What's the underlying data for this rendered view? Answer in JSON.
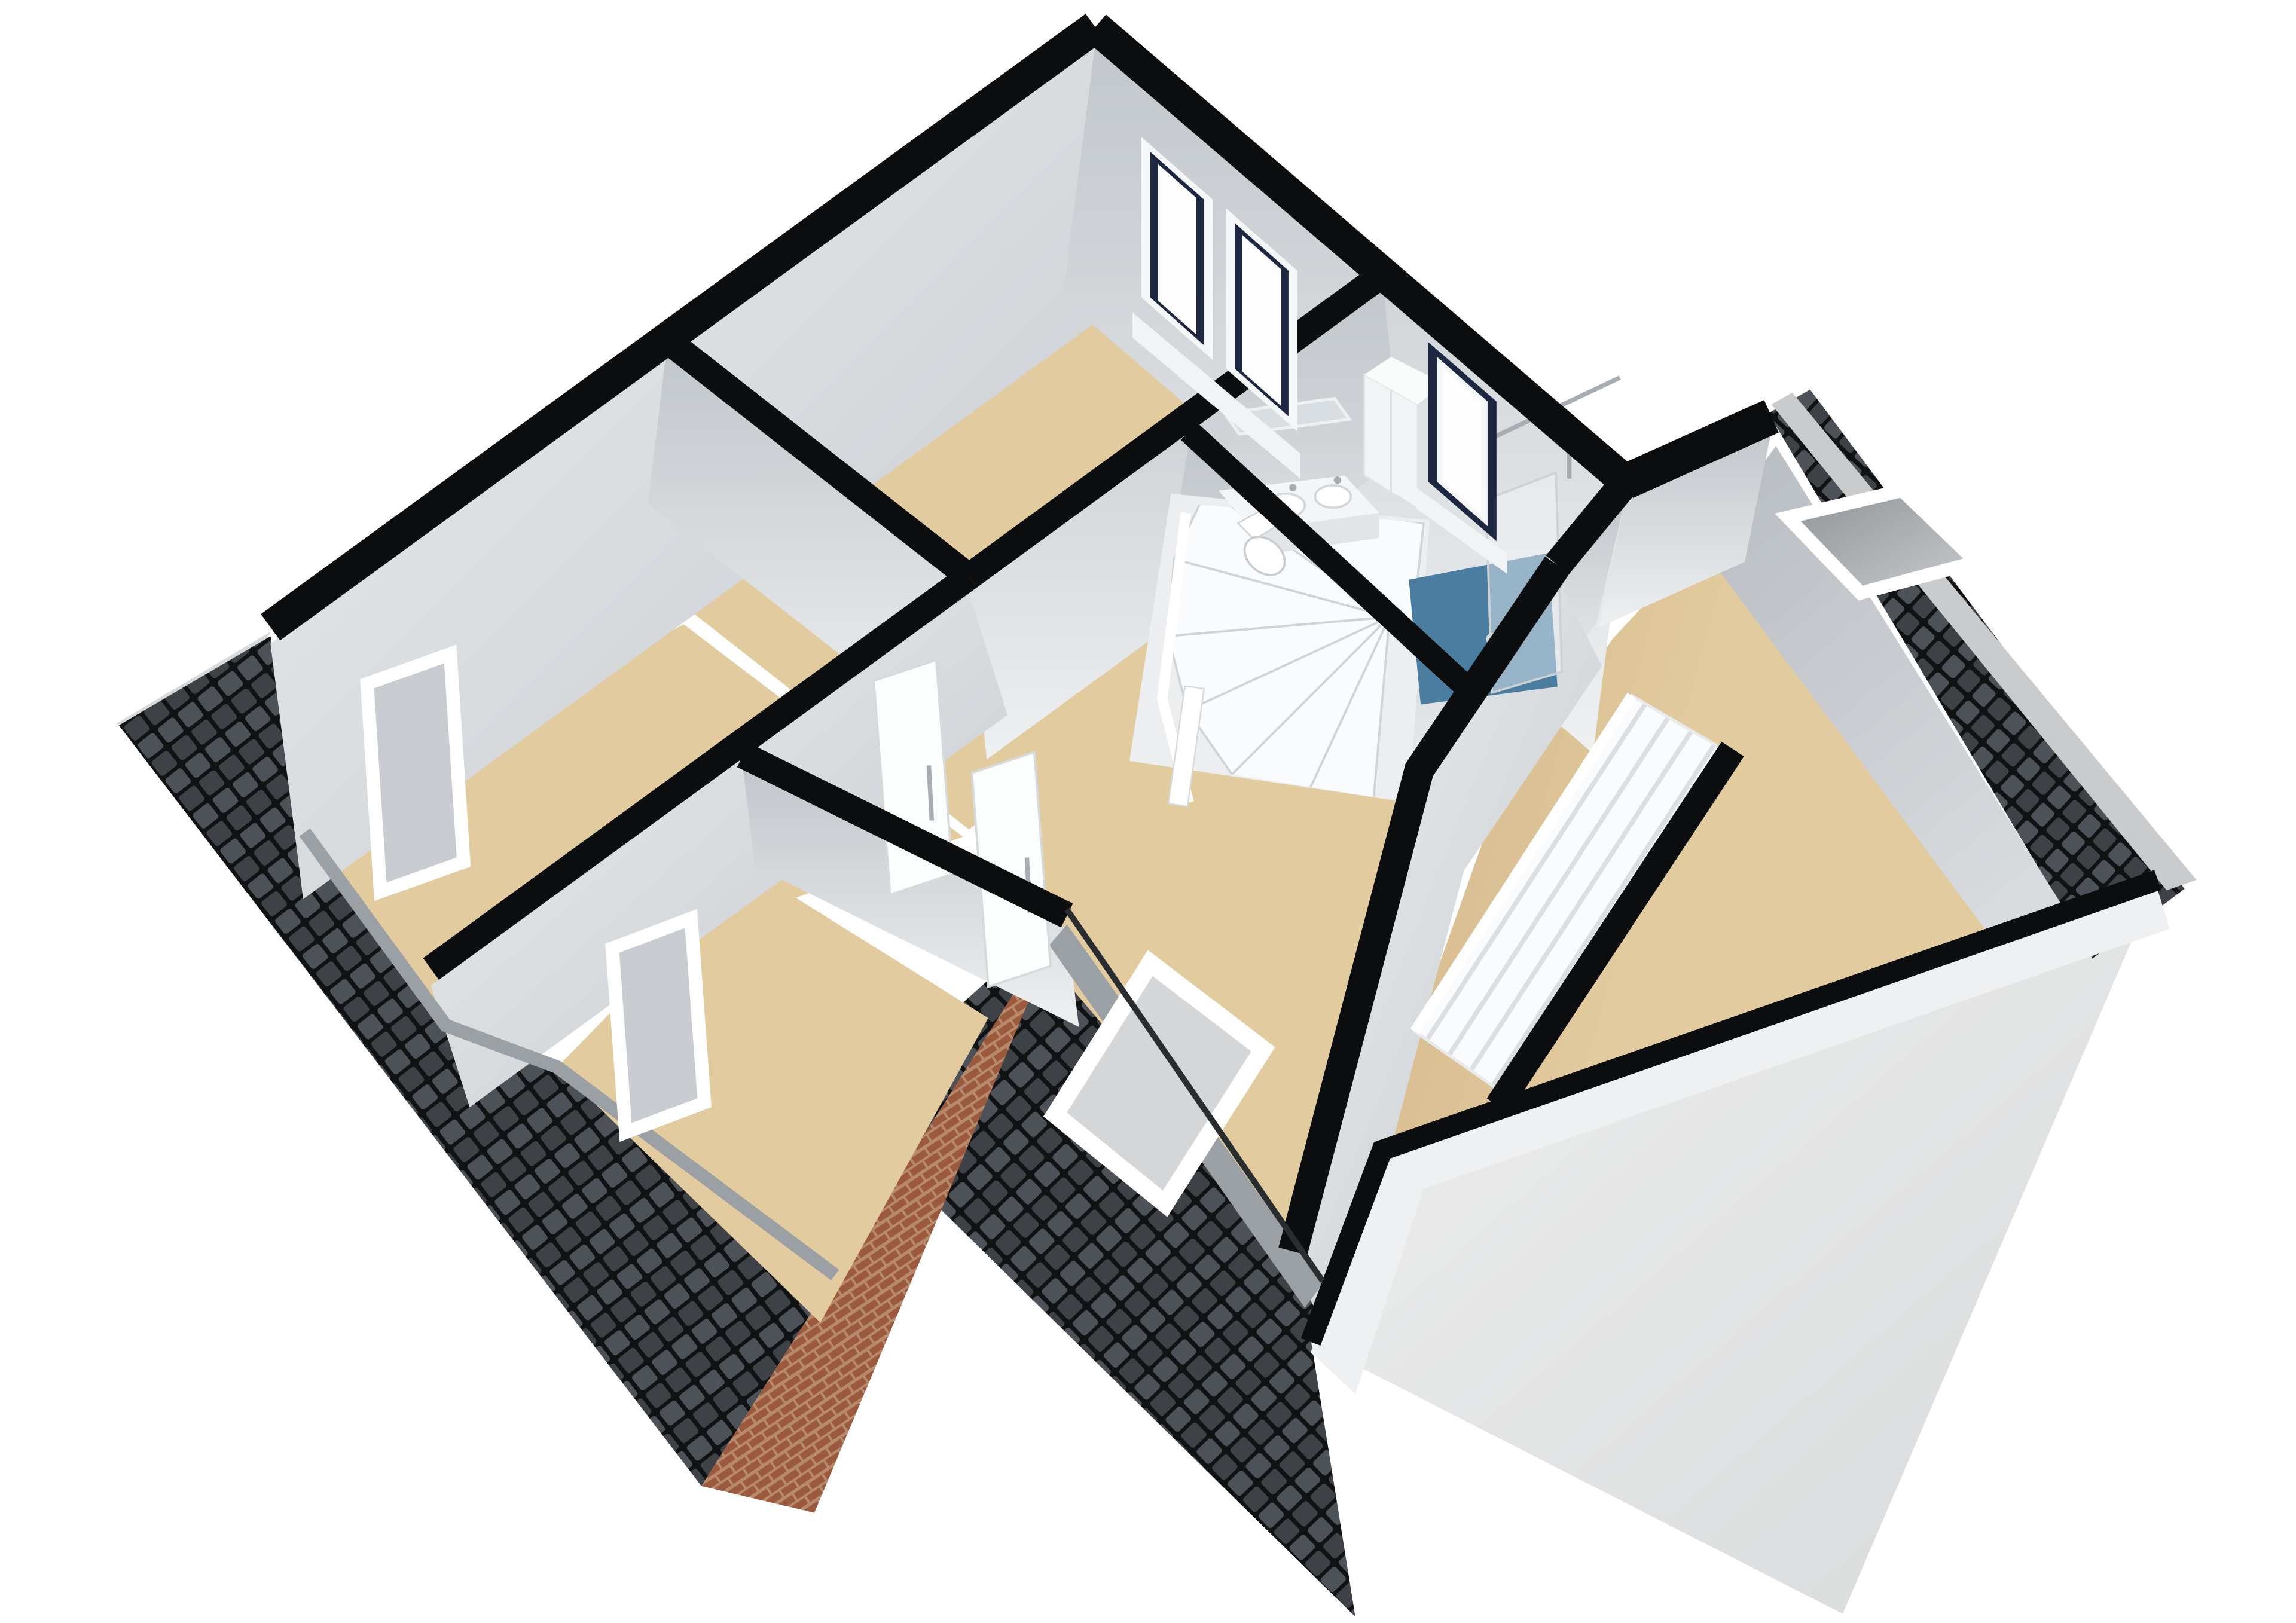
{
  "scene": {
    "label": "3D attic floor plan rendering",
    "view": "isometric-cutaway-top",
    "background": "white",
    "rooms": [
      {
        "name": "bedroom-top",
        "floor": "beige",
        "features": [
          "double-window-navy-frames"
        ]
      },
      {
        "name": "bathroom",
        "floor": "grey-with-blue-shower",
        "features": [
          "vanity-two-basins",
          "mirror",
          "tall-cabinet",
          "toilet",
          "walk-in-shower-blue-floor",
          "glass-panel",
          "shower-rod",
          "navy-framed-window"
        ]
      },
      {
        "name": "bedroom-left",
        "floor": "beige",
        "features": [
          "open-door-frame"
        ]
      },
      {
        "name": "room-small-middle",
        "floor": "beige",
        "features": [
          "open-door-frame"
        ]
      },
      {
        "name": "hallway-landing",
        "floor": "beige",
        "features": [
          "spiral-winder-staircase",
          "two-white-doors-with-handles",
          "handrail"
        ]
      },
      {
        "name": "big-room-right-wing",
        "floor": "beige",
        "features": [
          "straight-staircase-down",
          "roof-skylight-white-frame",
          "dormer-window-white-frame",
          "sloped-ceiling"
        ]
      }
    ],
    "roofs": [
      {
        "name": "roof-left-slope",
        "material": "dark-tiles"
      },
      {
        "name": "roof-bottom-slope",
        "material": "dark-tiles"
      },
      {
        "name": "roof-right-wing-ne-slope",
        "material": "dark-tiles",
        "features": [
          "skylight"
        ]
      }
    ],
    "other": [
      {
        "name": "brick-gable-wall",
        "material": "red-brick"
      },
      {
        "name": "gable-exterior-wall-right",
        "material": "plaster-light-grey"
      }
    ],
    "counts": {
      "windows": 4,
      "skylights": 1,
      "doors_frames": 2,
      "door_leaves": 2,
      "staircases": 2
    }
  },
  "colors": {
    "bg": "#ffffff",
    "wallTop": "#0c0d0e",
    "wallFaceLight": "#eef0f1",
    "wallFaceMid": "#c2c7cc",
    "wallFaceDark": "#9aa1a8",
    "floor": "#e2cb9e",
    "floorShade": "#cfb185",
    "bathFloor": "#e9eaec",
    "showerBlue": "#4b7da1",
    "tileBase": "#3e4246",
    "tileFace": "#4d5258",
    "tileGap": "#101214",
    "roofEdge": "#9ba0a4",
    "roofEdgeLight": "#c9cbcd",
    "brickMortar": "#b88a6d",
    "brick": "#9b593d",
    "exteriorLight": "#efefef",
    "exteriorMid": "#d7d9da",
    "white": "#fafbfc",
    "stairTread": "#dcdfe2",
    "navy": "#1d2742",
    "glass": "#d4d6d8",
    "chrome": "#a7adb2"
  }
}
